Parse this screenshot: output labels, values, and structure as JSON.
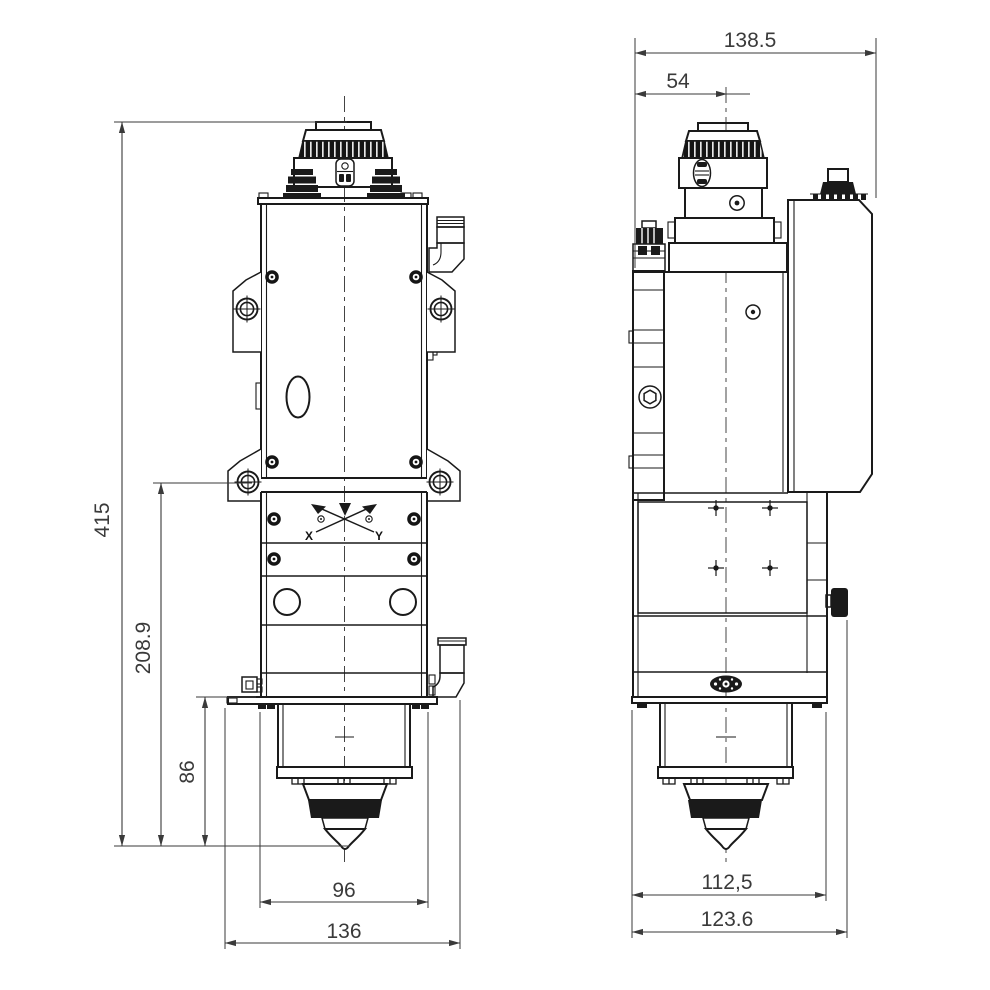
{
  "drawing": {
    "description": "Dimensioned two-view technical drawing of a fiber laser cutting head",
    "background": "#ffffff",
    "line_color": "#1a1a1a"
  },
  "front_view": {
    "dimensions": {
      "total_height": "415",
      "upper_section_height": "208.9",
      "nozzle_section_height": "86",
      "body_width": "96",
      "overall_width": "136"
    },
    "axis_marker": {
      "x_label": "X",
      "y_label": "Y"
    }
  },
  "side_view": {
    "dimensions": {
      "overall_width": "138.5",
      "center_offset": "54",
      "body_width": "112,5",
      "overall_width_incl_knob": "123.6"
    }
  }
}
